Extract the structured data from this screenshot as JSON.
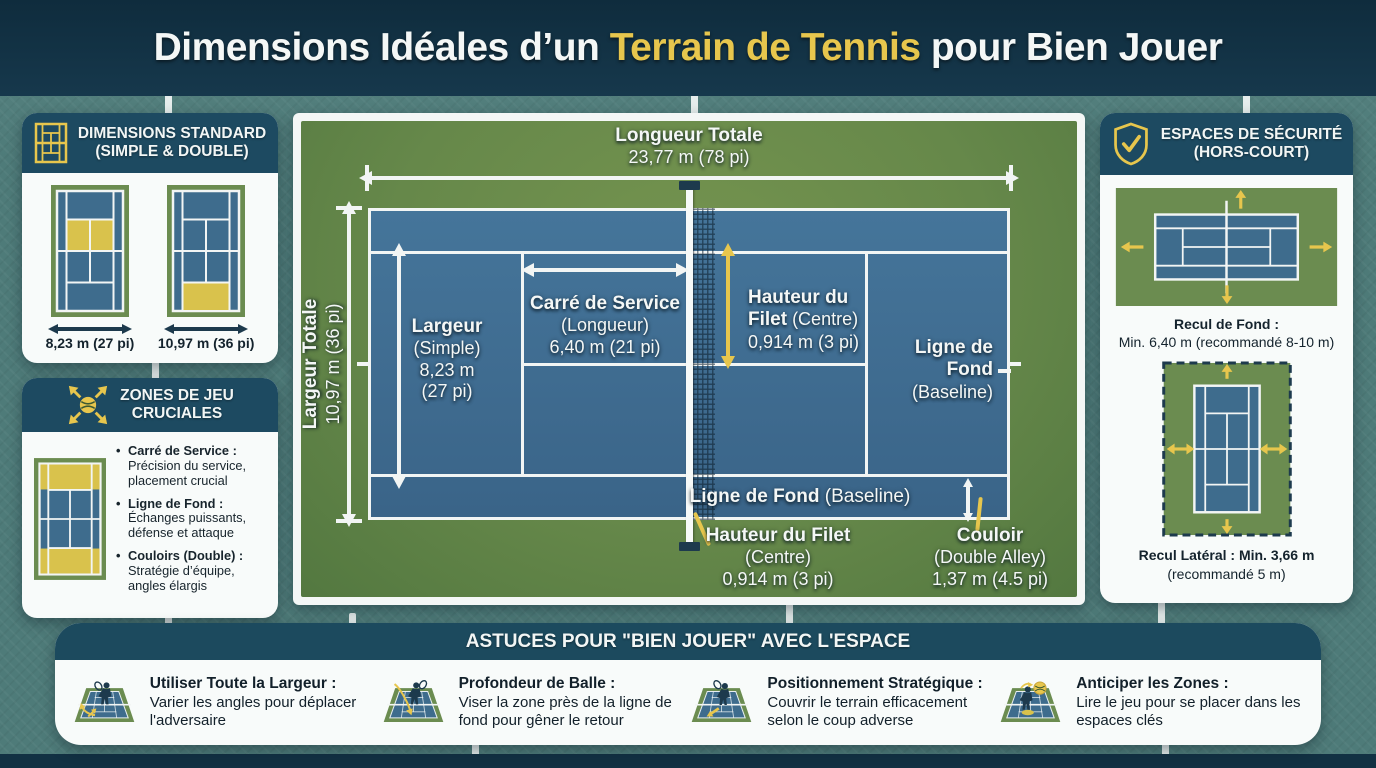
{
  "colors": {
    "accent_yellow": "#e7c64d",
    "court_blue": "#3e6c8d",
    "court_green": "#6b8c50",
    "navy_dark": "#1d3a4d",
    "header_bg": "#112f41",
    "panel_header_bg": "#1d4a61",
    "background_teal": "#4e7b79"
  },
  "header": {
    "title_pre": "Dimensions Idéales d’un ",
    "title_highlight": "Terrain de Tennis",
    "title_post": " pour Bien Jouer"
  },
  "standard": {
    "title1": "DIMENSIONS STANDARD",
    "title2": "(SIMPLE & DOUBLE)",
    "court1_label": "8,23 m (27 pi)",
    "court2_label": "10,97 m (36 pi)"
  },
  "zones": {
    "title1": "ZONES DE JEU",
    "title2": "CRUCIALES",
    "bullet": "•",
    "items": [
      {
        "term": "Carré de Service :",
        "desc": "Précision du service, placement crucial"
      },
      {
        "term": "Ligne de Fond :",
        "desc": "Échanges puissants, défense et attaque"
      },
      {
        "term": "Couloirs (Double) :",
        "desc": "Stratégie d’équipe, angles élargis"
      }
    ]
  },
  "security": {
    "title1": "ESPACES DE SÉCURITÉ",
    "title2": "(HORS-COURT)",
    "cap1_bold": "Recul de Fond :",
    "cap1_rest": "Min. 6,40 m (recommandé 8-10 m)",
    "cap2_bold": "Recul Latéral : Min. 3,66 m",
    "cap2_rest": "(recommandé 5 m)"
  },
  "diagram": {
    "longueur_title": "Longueur Totale",
    "longueur_value": "23,77 m (78 pi)",
    "largeur_totale_title": "Largeur Totale",
    "largeur_totale_value": "10,97 m (36 pi)",
    "largeur1": "Largeur",
    "largeur2": "(Simple)",
    "largeur3": "8,23 m",
    "largeur4": "(27 pi)",
    "service1": "Carré de Service",
    "service2": "(Longueur)",
    "service3": "6,40 m (21 pi)",
    "net_side1": "Hauteur du",
    "net_side2_bold": "Filet",
    "net_side2_rest": " (Centre)",
    "net_side3": "0,914 m (3 pi)",
    "baseline_r1": "Ligne de",
    "baseline_r2": "Fond",
    "baseline_r3": "(Baseline)",
    "baseline_bottom_bold": "Ligne de Fond",
    "baseline_bottom_rest": " (Baseline)",
    "net_bottom1": "Hauteur du Filet",
    "net_bottom2": "(Centre)",
    "net_bottom3": "0,914 m (3 pi)",
    "couloir1": "Couloir",
    "couloir2": "(Double Alley)",
    "couloir3": "1,37 m (4.5 pi)"
  },
  "footer": {
    "title": "ASTUCES POUR \"BIEN JOUER\" AVEC L'ESPACE",
    "tips": [
      {
        "bold": "Utiliser Toute la Largeur :",
        "text": "Varier les angles pour déplacer l'adversaire"
      },
      {
        "bold": "Profondeur de Balle :",
        "text": "Viser la zone près de la ligne de fond pour gêner le retour"
      },
      {
        "bold": "Positionnement Stratégique :",
        "text": "Couvrir le terrain efficacement selon le coup adverse"
      },
      {
        "bold": "Anticiper les Zones :",
        "text": "Lire le jeu pour se placer dans les espaces clés"
      }
    ]
  }
}
